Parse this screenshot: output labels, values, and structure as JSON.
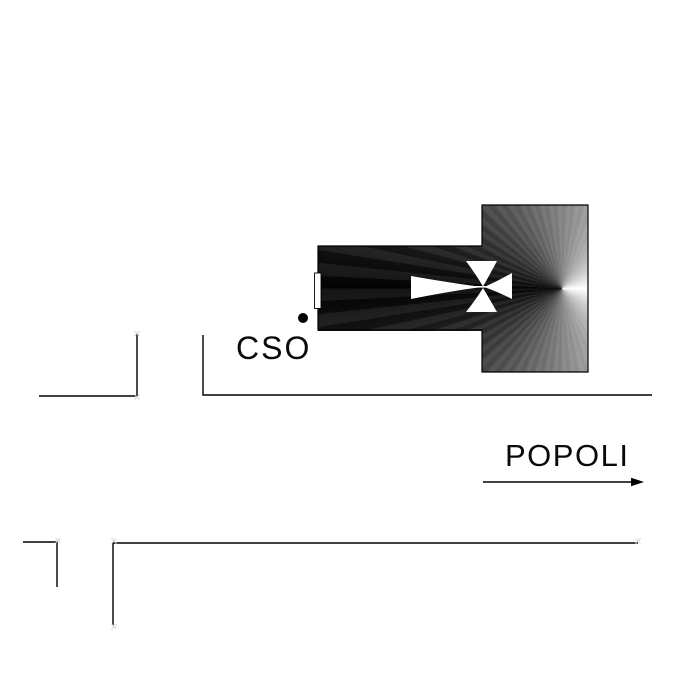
{
  "labels": {
    "corso_abbreviation": "CSO",
    "direction_destination": "POPOLI"
  },
  "icons": {
    "church_cross": "maltese-cross-icon",
    "direction": "right-arrow-icon",
    "point_of_interest": "poi-dot"
  },
  "colors": {
    "ink": "#000000",
    "paper": "#ffffff",
    "gradient_light": "#ffffff",
    "gradient_dark": "#030303",
    "marker_faint": "#d4d4d4",
    "label_ink": "#0a0a0a"
  }
}
